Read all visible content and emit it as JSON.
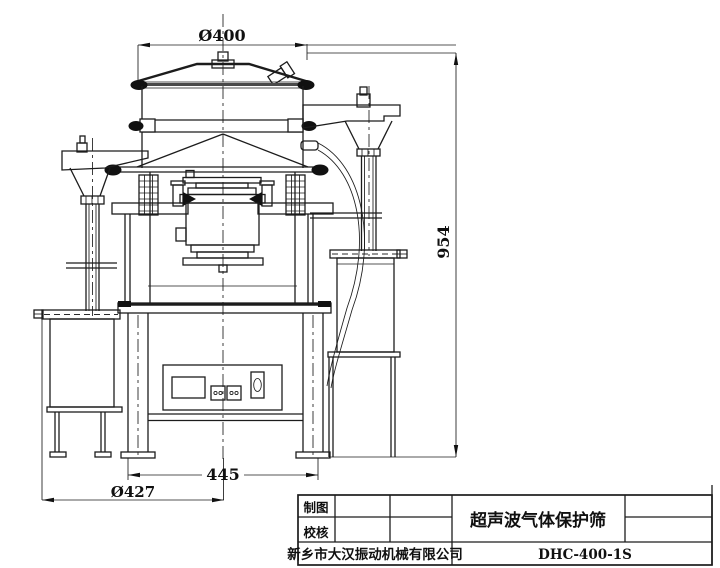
{
  "drawing": {
    "kind": "engineering-drawing",
    "subject": "ultrasonic gas protection vibrating sieve"
  },
  "dimensions": {
    "top_diameter": "Ø400",
    "total_height": "954",
    "base_width": "445",
    "base_diameter": "Ø427"
  },
  "title_block": {
    "drawn_label": "制图",
    "checked_label": "校核",
    "company": "新乡市大汉振动机械有限公司",
    "drawing_title": "超声波气体保护筛",
    "model": "DHC-400-1S"
  },
  "colors": {
    "line": "#1c1c1c",
    "background": "#ffffff"
  }
}
